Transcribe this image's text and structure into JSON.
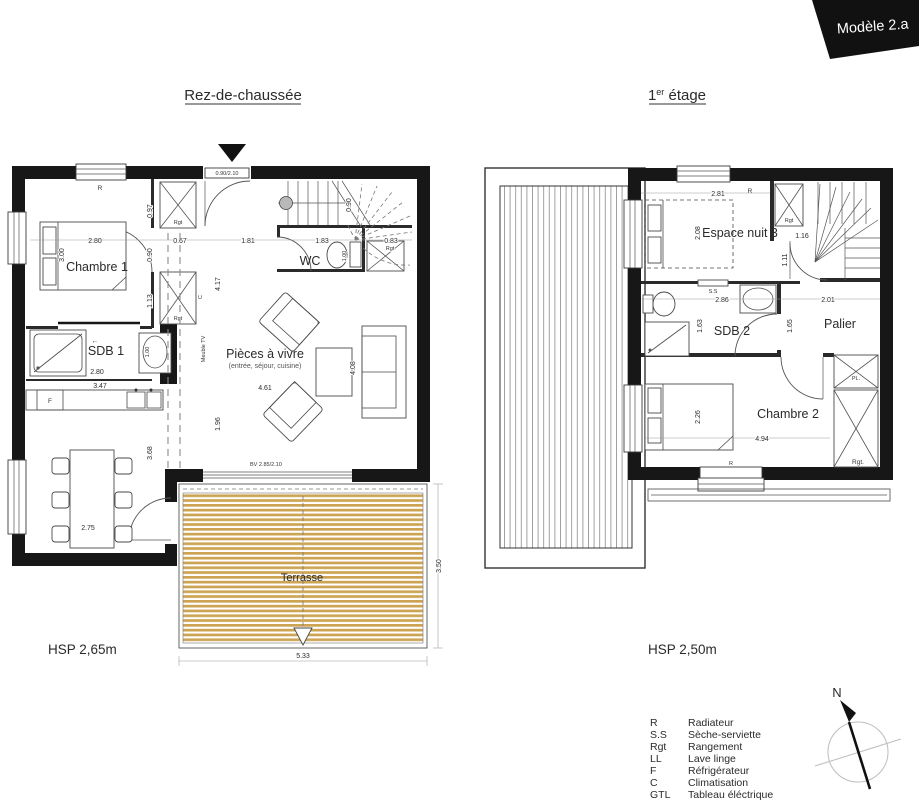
{
  "banner": {
    "label": "Modèle 2.a",
    "color": "#111111"
  },
  "compass": {
    "north": "N"
  },
  "colors": {
    "wall": "#171717",
    "deck_stripe": "#cda453",
    "text": "#2b2b2b"
  },
  "ground": {
    "title": "Rez-de-chaussée",
    "hsp": "HSP 2,65m",
    "rooms": {
      "chambre1": "Chambre 1",
      "sdb1": "SDB 1",
      "wc": "WC",
      "living": "Pièces à vivre",
      "living_sub": "(entrée, séjour, cuisine)",
      "terrace": "Terrasse"
    },
    "labels": {
      "radiator": "R",
      "rgt_top": "Rgt",
      "rgt_mid": "Rgt",
      "rgt_stairs": "Rgt",
      "fridge": "F",
      "meuble_tv": "Meuble TV",
      "clim": "C",
      "entry_door": "0.90/2.10",
      "bay_window": "BV 2.85/2.10",
      "slide_arrow": "←"
    },
    "dims": {
      "bed_w": "2.80",
      "bed_h": "3.00",
      "v097": "0.97",
      "v090": "0.90",
      "v113": "1.13",
      "h067": "0.67",
      "hall_h": "4.17",
      "e181": "1.81",
      "e183": "1.83",
      "e083": "0.83",
      "stairs_w": "0.90",
      "wc_depth": "1.00",
      "sdb_sink": "1.00",
      "sdb_w": "2.80",
      "kitchen_w": "3.47",
      "dining_w": "2.75",
      "dining_h": "3.68",
      "v196": "1.96",
      "living_w": "4.61",
      "living_h": "4.08",
      "terrace_w": "5.33",
      "terrace_h": "3.50"
    }
  },
  "first": {
    "title_num": "1",
    "title_sup": "er",
    "title_rest": " étage",
    "hsp": "HSP 2,50m",
    "rooms": {
      "espace": "Espace nuit 3",
      "sdb2": "SDB 2",
      "palier": "Palier",
      "chambre2": "Chambre 2"
    },
    "labels": {
      "radiator_top": "R",
      "radiator_bottom": "R",
      "rgt_top": "Rgt",
      "ss": "S.S",
      "pl": "PL.",
      "rgt_bottom": "Rgt."
    },
    "dims": {
      "top_w": "2.81",
      "bed_h": "2.08",
      "stairs": "1.16",
      "door": "1.11",
      "sdb_w": "2.86",
      "palier_w": "2.01",
      "v163": "1.63",
      "v165": "1.65",
      "bed2_h": "2.26",
      "room_w": "4.94"
    }
  },
  "legend": {
    "items": [
      {
        "abbr": "R",
        "label": "Radiateur"
      },
      {
        "abbr": "S.S",
        "label": "Sèche-serviette"
      },
      {
        "abbr": "Rgt",
        "label": "Rangement"
      },
      {
        "abbr": "LL",
        "label": "Lave linge"
      },
      {
        "abbr": "F",
        "label": "Réfrigérateur"
      },
      {
        "abbr": "C",
        "label": "Climatisation"
      },
      {
        "abbr": "GTL",
        "label": "Tableau éléctrique"
      }
    ]
  }
}
